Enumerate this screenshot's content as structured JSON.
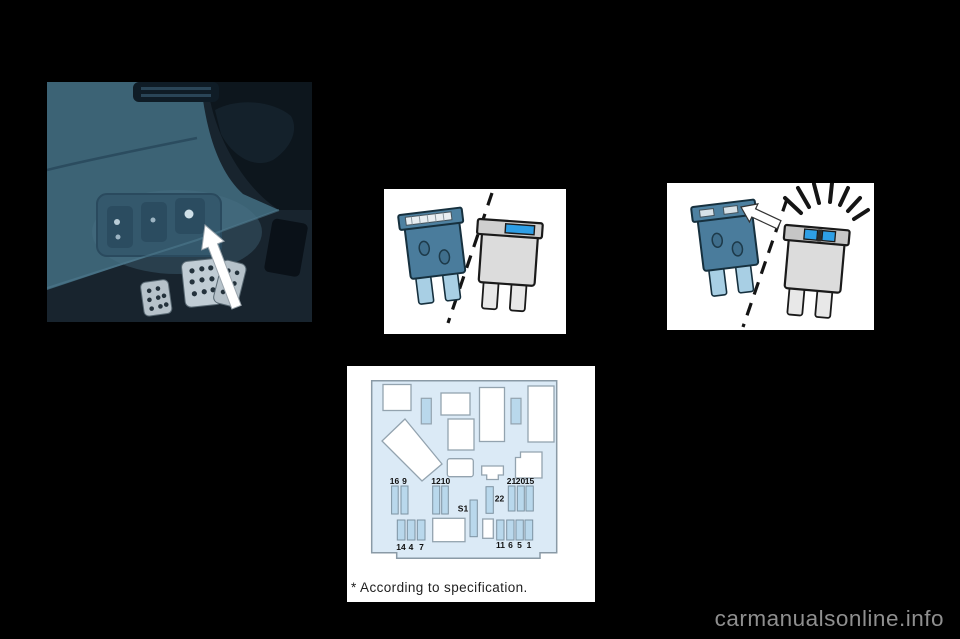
{
  "page": {
    "watermark": "carmanualsonline.info",
    "background_color": "#000000"
  },
  "colors": {
    "panel_blue": "#dbeaf6",
    "fuse_blue": "#b9d8ec",
    "steel_fuse_blue": "#4a7c9c",
    "fuse_leg_blue": "#a8cfe4",
    "fuse_element_blue": "#2e9fe6",
    "gray_fuse": "#dcdcdc",
    "watermark_gray": "#8f8f8f"
  },
  "fuse_box": {
    "labels_mid_left": [
      "16",
      "9"
    ],
    "labels_mid_center": [
      "12",
      "10"
    ],
    "label_fuse_22": "22",
    "label_socket_s1": "S1",
    "labels_mid_right": [
      "21",
      "20",
      "15"
    ],
    "labels_bottom_left": [
      "14",
      "4",
      "7"
    ],
    "labels_bottom_right": [
      "11",
      "6",
      "5",
      "1"
    ],
    "footnote": "* According to specification."
  }
}
